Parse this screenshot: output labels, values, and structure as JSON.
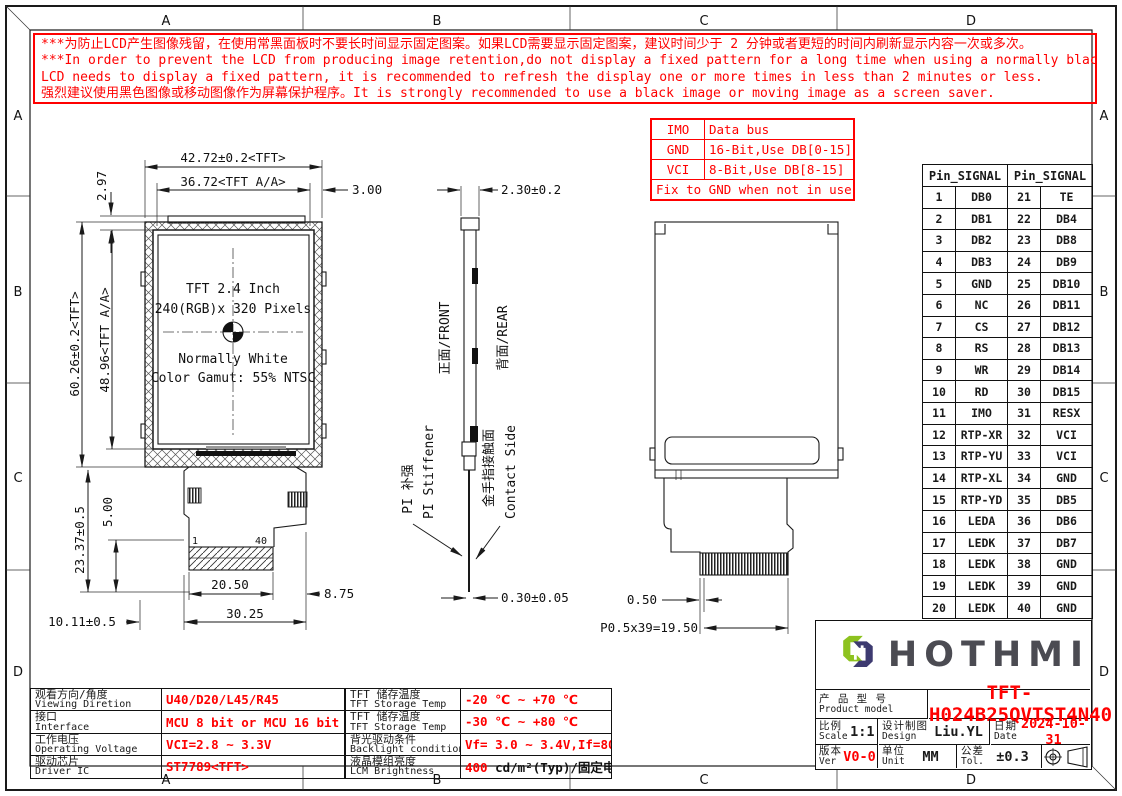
{
  "colors": {
    "red": "#ff0000",
    "line": "#1a1a1a",
    "logo_green": "#8dc21f",
    "logo_navy": "#3d3a70",
    "brand_gray": "#4b4b52"
  },
  "zones": {
    "cols": [
      "A",
      "B",
      "C",
      "D"
    ],
    "rows": [
      "A",
      "B",
      "C",
      "D"
    ]
  },
  "warning": {
    "lines": [
      "***为防止LCD产生图像残留，在使用常黑面板时不要长时间显示固定图案。如果LCD需要显示固定图案，建议时间少于 2 分钟或者更短的时间内刷新显示内容一次或多次。",
      "***In order to prevent the LCD from producing image retention,do not display a fixed pattern for a long time when using a normally black panel.If the",
      " LCD needs to display a fixed pattern, it is recommended to refresh the display one or more times in less than 2 minutes or less.",
      "强烈建议使用黑色图像或移动图像作为屏幕保护程序。It is strongly recommended to use a black image or moving image as a screen saver."
    ]
  },
  "imo_table": {
    "rows": [
      {
        "k": "IMO",
        "v": "Data bus"
      },
      {
        "k": "GND",
        "v": "16-Bit,Use DB[0-15]"
      },
      {
        "k": "VCI",
        "v": "8-Bit,Use DB[8-15]"
      }
    ],
    "footer": "Fix to GND when not in use."
  },
  "pin_table": {
    "header_left": "Pin_SIGNAL",
    "header_right": "Pin_SIGNAL",
    "rows": [
      [
        "1",
        "DB0",
        "21",
        "TE"
      ],
      [
        "2",
        "DB1",
        "22",
        "DB4"
      ],
      [
        "3",
        "DB2",
        "23",
        "DB8"
      ],
      [
        "4",
        "DB3",
        "24",
        "DB9"
      ],
      [
        "5",
        "GND",
        "25",
        "DB10"
      ],
      [
        "6",
        "NC",
        "26",
        "DB11"
      ],
      [
        "7",
        "CS",
        "27",
        "DB12"
      ],
      [
        "8",
        "RS",
        "28",
        "DB13"
      ],
      [
        "9",
        "WR",
        "29",
        "DB14"
      ],
      [
        "10",
        "RD",
        "30",
        "DB15"
      ],
      [
        "11",
        "IMO",
        "31",
        "RESX"
      ],
      [
        "12",
        "RTP-XR",
        "32",
        "VCI"
      ],
      [
        "13",
        "RTP-YU",
        "33",
        "VCI"
      ],
      [
        "14",
        "RTP-XL",
        "34",
        "GND"
      ],
      [
        "15",
        "RTP-YD",
        "35",
        "DB5"
      ],
      [
        "16",
        "LEDA",
        "36",
        "DB6"
      ],
      [
        "17",
        "LEDK",
        "37",
        "DB7"
      ],
      [
        "18",
        "LEDK",
        "38",
        "GND"
      ],
      [
        "19",
        "LEDK",
        "39",
        "GND"
      ],
      [
        "20",
        "LEDK",
        "40",
        "GND"
      ]
    ]
  },
  "front_view": {
    "dim_w_tft": "42.72±0.2<TFT>",
    "dim_w_aa": "36.72<TFT A/A>",
    "dim_3": "3.00",
    "dim_297": "2.97",
    "dim_h_tft": "60.26±0.2<TFT>",
    "dim_h_aa": "48.96<TFT A/A>",
    "dim_tail": "23.37±0.5",
    "dim_5": "5.00",
    "dim_1011": "10.11±0.5",
    "dim_2050": "20.50",
    "dim_875": "8.75",
    "dim_3025": "30.25",
    "pin_first": "1",
    "pin_last": "40",
    "screen_lines": [
      "TFT 2.4 Inch",
      "240(RGB)x 320 Pixels",
      "Normally White",
      "Color Gamut: 55% NTSC"
    ]
  },
  "side_view": {
    "dim_thk": "2.30±0.2",
    "front": "正面/FRONT",
    "rear": "背面/REAR",
    "pi_cn": "PI 补强",
    "pi_en": "PI Stiffener",
    "contact_cn": "金手指接触面",
    "contact_en": "Contact Side",
    "dim_fpc": "0.30±0.05"
  },
  "rear_view": {
    "dim_050": "0.50",
    "dim_pitch": "P0.5x39=19.50"
  },
  "specs_left": {
    "rows": [
      {
        "cn": "观看方向/角度",
        "en": "Viewing Diretion",
        "value": "U40/D20/L45/R45"
      },
      {
        "cn": "接口",
        "en": "Interface",
        "value": "MCU 8 bit or MCU 16 bit"
      },
      {
        "cn": "工作电压",
        "en": "Operating Voltage",
        "value": "VCI=2.8 ~ 3.3V"
      },
      {
        "cn": "驱动芯片",
        "en": "Driver IC",
        "value": "ST7789<TFT>"
      }
    ]
  },
  "specs_mid": {
    "rows": [
      {
        "cn": "TFT 储存温度",
        "en": "TFT Storage Temp",
        "red": "-20 ℃ ~ +70 ℃",
        "black": ""
      },
      {
        "cn": "TFT 储存温度",
        "en": "TFT Storage Temp",
        "red": "-30 ℃ ~ +80 ℃",
        "black": ""
      },
      {
        "cn": "背光驱动条件",
        "en": "Backlight conditions",
        "red": "Vf= 3.0 ~ 3.4V,If=80mA",
        "black": ""
      },
      {
        "cn": "液晶模组亮度",
        "en": "LCM Brightness",
        "red": "400",
        "black": " cd/m²(Typ)/固定电流测试"
      }
    ]
  },
  "title_block": {
    "brand": "HOTHMI",
    "product_cn": "产 品 型 号",
    "product_en": "Product model",
    "model": "TFT-H024B25QVTST4N40",
    "scale_cn": "比例",
    "scale_en": "Scale",
    "scale": "1:1",
    "design_cn": "设计制图",
    "design_en": "Design",
    "designer": "Liu.YL",
    "date_cn": "日期",
    "date_en": "Date",
    "date": "2024-10-31",
    "ver_cn": "版本",
    "ver_en": "Ver",
    "ver": "V0-0",
    "unit_cn": "单位",
    "unit_en": "Unit",
    "unit": "MM",
    "tol_cn": "公差",
    "tol_en": "Tol.",
    "tol": "±0.3"
  }
}
